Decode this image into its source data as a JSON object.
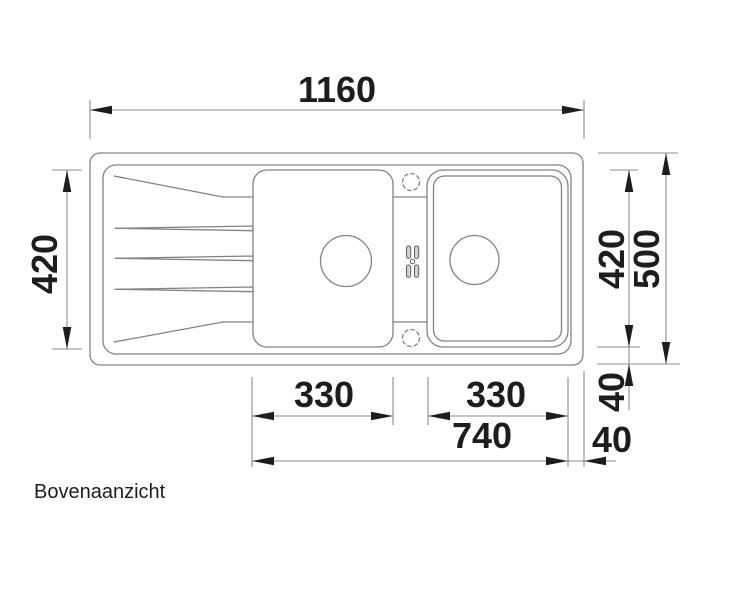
{
  "caption": "Bovenaanzicht",
  "dimensions_mm": {
    "total_width": "1160",
    "total_depth": "500",
    "basin_depth": "420",
    "left_bowl_width": "330",
    "right_bowl_width": "330",
    "bowls_span": "740",
    "right_edge_offset": "40",
    "bottom_edge_offset": "40"
  },
  "colors": {
    "background": "#ffffff",
    "drawing_line": "#828282",
    "dimension_line": "#8c8c8c",
    "ink": "#1d1d1d",
    "pill_fill": "#d2d2d2",
    "pill_stroke": "#5f5f5f"
  },
  "sink": {
    "outer": {
      "x": 90,
      "y": 153,
      "w": 493,
      "h": 212,
      "r": 10
    },
    "rim": {
      "x": 103,
      "y": 165,
      "w": 468,
      "h": 189,
      "r": 13
    },
    "left_basin": {
      "x": 253,
      "y": 170,
      "w": 140,
      "h": 177,
      "r": 14
    },
    "right_basin_outer": {
      "x": 427,
      "y": 170,
      "w": 141,
      "h": 177,
      "r": 16
    },
    "right_basin_inner": {
      "x": 433.5,
      "y": 176,
      "w": 128,
      "h": 165,
      "r": 11
    },
    "divider_lines": [
      [
        393,
        197,
        427,
        197
      ],
      [
        393,
        322,
        427,
        322
      ]
    ],
    "drainboard_marks": [
      [
        [
          114,
          176
        ],
        [
          223,
          197
        ],
        [
          253,
          197
        ]
      ],
      [
        [
          114,
          342
        ],
        [
          223,
          322
        ],
        [
          253,
          322
        ]
      ]
    ],
    "grooves": [
      [
        [
          115,
          228.3
        ],
        [
          253,
          226
        ],
        [
          253,
          230.7
        ]
      ],
      [
        [
          115,
          258.3
        ],
        [
          253,
          256
        ],
        [
          253,
          260.7
        ]
      ],
      [
        [
          115,
          289.3
        ],
        [
          253,
          287
        ],
        [
          253,
          291.7
        ]
      ]
    ],
    "drains": [
      {
        "cx": 346,
        "cy": 261,
        "r": 25.5
      },
      {
        "cx": 474.5,
        "cy": 260,
        "r": 24.5
      }
    ],
    "tap_holes": [
      {
        "cx": 411,
        "cy": 182,
        "r": 8.5
      },
      {
        "cx": 411,
        "cy": 338,
        "r": 8.5
      }
    ],
    "overflow": {
      "pill_w": 4.2,
      "pill_h": 12.4,
      "pills": [
        {
          "x": 406.5,
          "y": 246
        },
        {
          "x": 414.5,
          "y": 246
        },
        {
          "x": 406.5,
          "y": 265
        },
        {
          "x": 414.5,
          "y": 265
        }
      ],
      "dot": {
        "cx": 412.5,
        "cy": 261.5,
        "r": 2.3
      }
    }
  },
  "extensions": [
    [
      90,
      100,
      90,
      139
    ],
    [
      584,
      100,
      584,
      139
    ],
    [
      52,
      170,
      82,
      170
    ],
    [
      52,
      349,
      82,
      349
    ],
    [
      610,
      170,
      638,
      170
    ],
    [
      597,
      347,
      640,
      347
    ],
    [
      598,
      153,
      678,
      153
    ],
    [
      597,
      364,
      680,
      364
    ],
    [
      252,
      377,
      252,
      467
    ],
    [
      393,
      377,
      393,
      425
    ],
    [
      428,
      377,
      428,
      425
    ],
    [
      568,
      377,
      568,
      467
    ],
    [
      584,
      371,
      584,
      467
    ]
  ],
  "dimensions": [
    {
      "label": "1160",
      "name": "dim-total-width-1160",
      "line": [
        90,
        110,
        584,
        110
      ],
      "arrows": [
        {
          "tip": [
            90,
            110
          ],
          "dir": "left"
        },
        {
          "tip": [
            584,
            110
          ],
          "dir": "right"
        }
      ],
      "text": {
        "x": 337,
        "y": 102,
        "rotate": 0
      }
    },
    {
      "label": "420",
      "name": "dim-basin-depth-left-420",
      "line": [
        67,
        170,
        67,
        349
      ],
      "arrows": [
        {
          "tip": [
            67,
            170
          ],
          "dir": "up"
        },
        {
          "tip": [
            67,
            349
          ],
          "dir": "down"
        }
      ],
      "text": {
        "x": 57,
        "y": 264,
        "rotate": -90
      }
    },
    {
      "label": "420",
      "name": "dim-basin-depth-right-420",
      "line": [
        629,
        170,
        629,
        347
      ],
      "arrows": [
        {
          "tip": [
            629,
            170
          ],
          "dir": "up"
        },
        {
          "tip": [
            629,
            347
          ],
          "dir": "down"
        }
      ],
      "text": {
        "x": 624,
        "y": 259,
        "rotate": -90
      }
    },
    {
      "label": "500",
      "name": "dim-total-depth-500",
      "line": [
        666,
        153,
        666,
        364
      ],
      "arrows": [
        {
          "tip": [
            666,
            153
          ],
          "dir": "up"
        },
        {
          "tip": [
            666,
            364
          ],
          "dir": "down"
        }
      ],
      "text": {
        "x": 659,
        "y": 259,
        "rotate": -90
      }
    },
    {
      "label": "40",
      "name": "dim-edge-offset-right-40",
      "line": [
        629,
        347,
        629,
        410
      ],
      "arrows": [
        {
          "tip": [
            629,
            364
          ],
          "dir": "up"
        }
      ],
      "text": {
        "x": 624,
        "y": 392,
        "rotate": -90
      }
    },
    {
      "label": "330",
      "name": "dim-left-bowl-330",
      "line": [
        252,
        416,
        393,
        416
      ],
      "arrows": [
        {
          "tip": [
            252,
            416
          ],
          "dir": "left"
        },
        {
          "tip": [
            393,
            416
          ],
          "dir": "right"
        }
      ],
      "text": {
        "x": 324,
        "y": 407,
        "rotate": 0
      }
    },
    {
      "label": "330",
      "name": "dim-right-bowl-330",
      "line": [
        428,
        416,
        568,
        416
      ],
      "arrows": [
        {
          "tip": [
            428,
            416
          ],
          "dir": "left"
        },
        {
          "tip": [
            568,
            416
          ],
          "dir": "right"
        }
      ],
      "text": {
        "x": 496,
        "y": 407,
        "rotate": 0
      }
    },
    {
      "label": "740",
      "name": "dim-bowls-span-740",
      "line": [
        252,
        461,
        568,
        461
      ],
      "arrows": [
        {
          "tip": [
            252,
            461
          ],
          "dir": "left"
        },
        {
          "tip": [
            568,
            461
          ],
          "dir": "right"
        }
      ],
      "text": {
        "x": 482,
        "y": 448,
        "rotate": 0
      }
    },
    {
      "label": "40",
      "name": "dim-edge-offset-bottom-40",
      "line": [
        568,
        461,
        616,
        461
      ],
      "arrows": [
        {
          "tip": [
            584,
            461
          ],
          "dir": "left"
        }
      ],
      "text": {
        "x": 612,
        "y": 452,
        "rotate": 0
      }
    }
  ]
}
